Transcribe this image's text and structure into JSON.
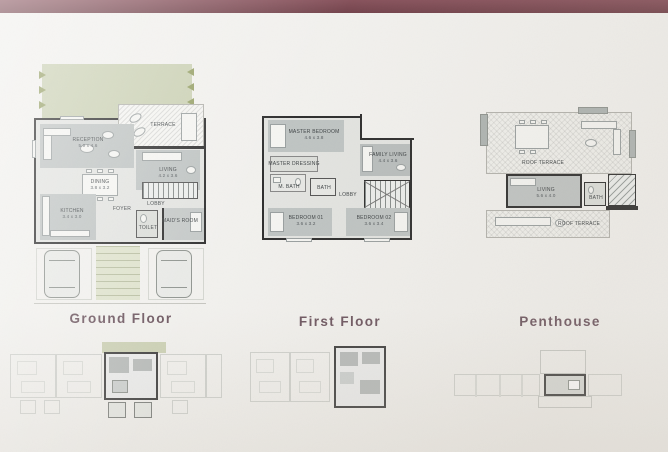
{
  "accent": {
    "top_bar_color": "#7c4a53",
    "floor_label_color": "#6d5660",
    "garden_green": "#cbd1b4",
    "wall_color": "#2e2e2e",
    "room_fill": "#bfc4c3",
    "paper_color": "#f2f1ee"
  },
  "floors": {
    "ground": {
      "label": "Ground Floor",
      "rooms": {
        "terrace": {
          "name": "TERRACE"
        },
        "reception": {
          "name": "RECEPTION",
          "dims": "5.0 x 4.6"
        },
        "living": {
          "name": "LIVING",
          "dims": "4.2 x 3.6"
        },
        "dining": {
          "name": "DINING",
          "dims": "3.8 x 3.2"
        },
        "kitchen": {
          "name": "KITCHEN",
          "dims": "3.4 x 3.0"
        },
        "foyer": {
          "name": "FOYER"
        },
        "lobby": {
          "name": "LOBBY"
        },
        "toilet": {
          "name": "TOILET"
        },
        "maids": {
          "name": "MAID'S ROOM"
        }
      }
    },
    "first": {
      "label": "First Floor",
      "rooms": {
        "master": {
          "name": "MASTER BEDROOM",
          "dims": "4.6 x 3.8"
        },
        "dressing": {
          "name": "MASTER DRESSING"
        },
        "mbath": {
          "name": "M. BATH"
        },
        "family": {
          "name": "FAMILY LIVING",
          "dims": "4.4 x 3.6"
        },
        "lobby": {
          "name": "LOBBY"
        },
        "bath": {
          "name": "BATH"
        },
        "bed1": {
          "name": "BEDROOM 01",
          "dims": "3.6 x 3.2"
        },
        "bed2": {
          "name": "BEDROOM 02",
          "dims": "3.6 x 3.4"
        }
      }
    },
    "penthouse": {
      "label": "Penthouse",
      "rooms": {
        "roof_upper": {
          "name": "ROOF TERRACE"
        },
        "living": {
          "name": "LIVING",
          "dims": "5.6 x 4.0"
        },
        "bath": {
          "name": "BATH"
        },
        "roof_lower": {
          "name": "ROOF TERRACE"
        }
      }
    }
  }
}
